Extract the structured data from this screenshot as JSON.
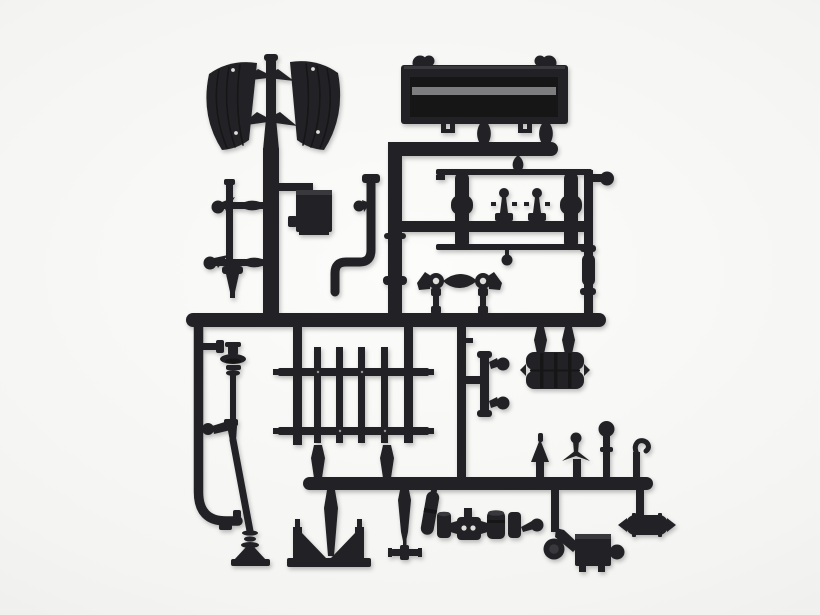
{
  "meta": {
    "alt": "Black plastic model kit sprue with truck detail parts photographed on a light gray studio background",
    "subject": "injection-molded parts tree (sprue) with scale-model truck parts"
  },
  "colors": {
    "plastic": "#232327",
    "plastic_dark": "#141417",
    "plastic_mid": "#37373c",
    "plastic_highlight": "#97979b",
    "hole": "#dededb",
    "background_center": "#fcfcfb",
    "background_mid": "#f4f4f2",
    "background_edge": "#e7e7e5"
  },
  "parts": [
    "left-mudguard",
    "right-mudguard",
    "center-pole",
    "cargo-box",
    "frame-rack",
    "axle-beam",
    "twin-tank",
    "grille-panel",
    "steering-column",
    "exhaust-pipe",
    "battery-box",
    "knob-bracket",
    "jack-stand",
    "support-bracket",
    "cross-fitting",
    "drum-cylinder",
    "wheel-disc",
    "tool-box",
    "air-tank",
    "valve-uprights",
    "main-runner",
    "bottom-runner"
  ]
}
